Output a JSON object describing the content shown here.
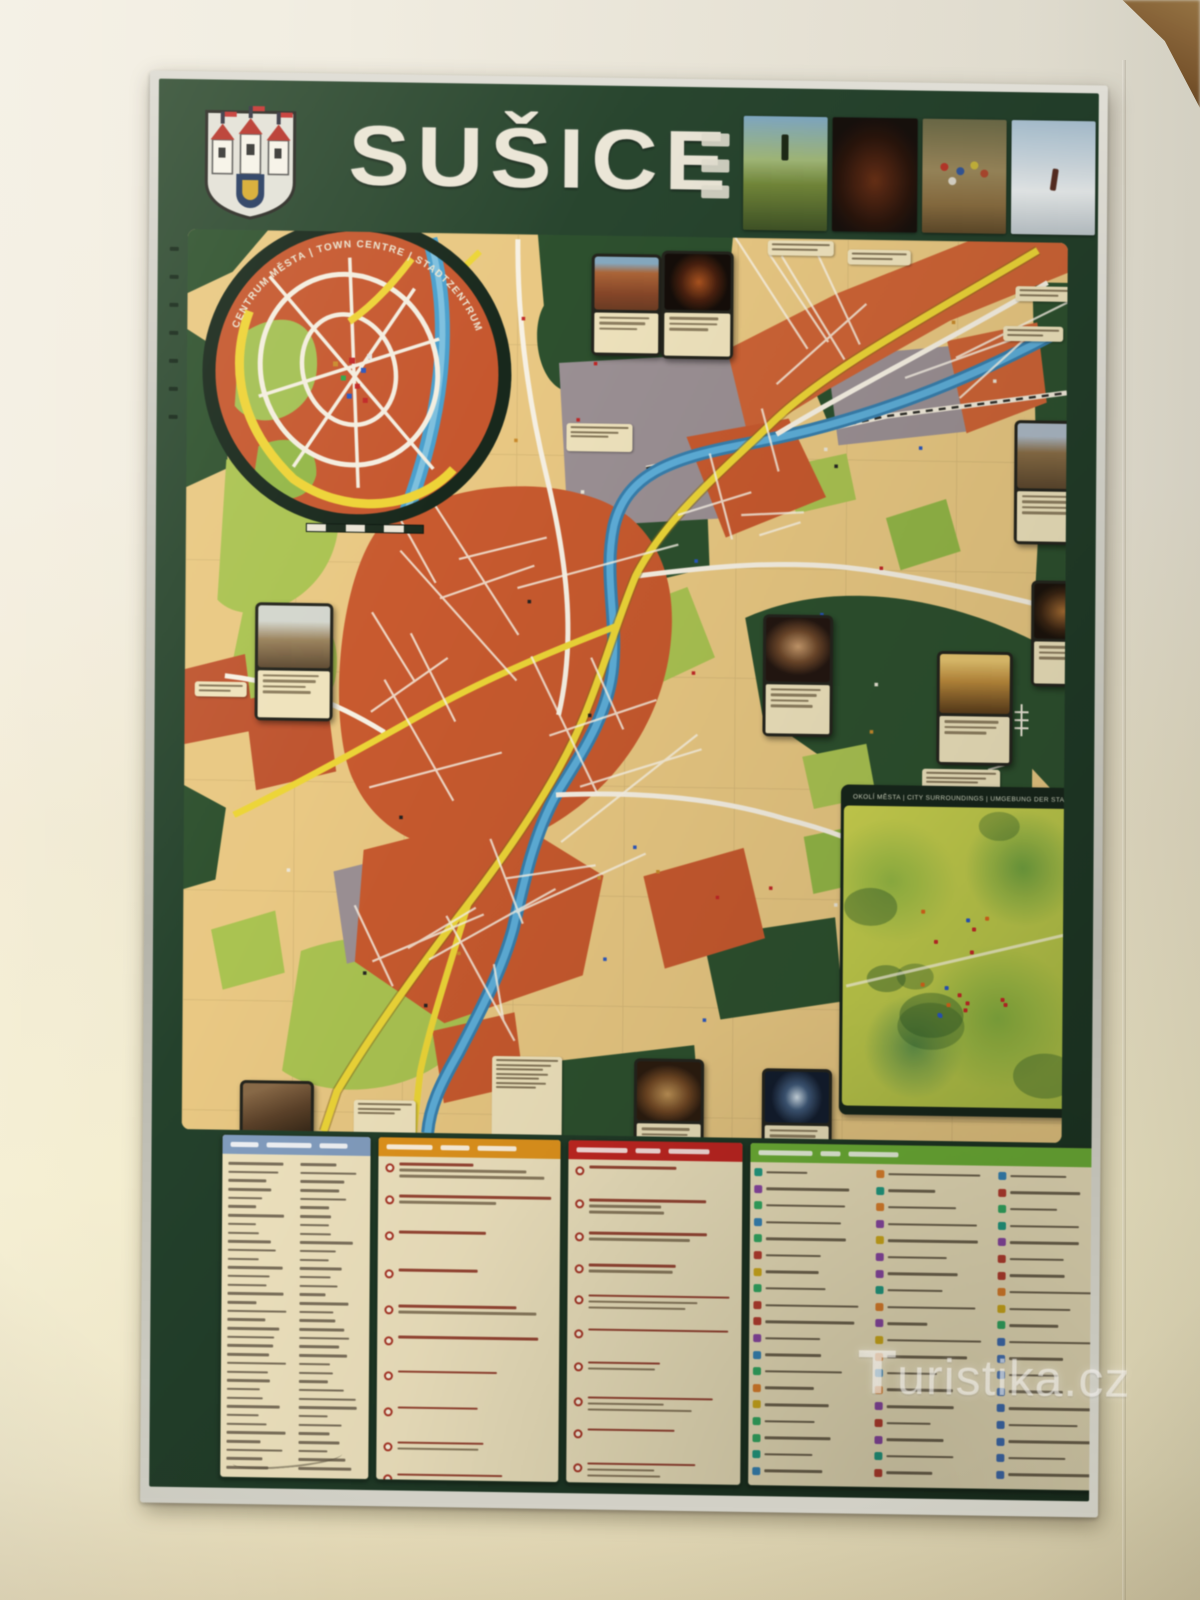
{
  "scene": {
    "description": "Photograph of a framed tourist map poster of Susice hanging on an interior wall",
    "wall_color": "#ece8d8",
    "frame_color": "#b9b9b1"
  },
  "poster": {
    "title": "SUŠICE",
    "title_color": "#e7e4d6",
    "header_bg": "#20402a",
    "coat_of_arms": "susice-city-coat-of-arms",
    "header_photos": [
      {
        "name": "memorial-on-meadow-photo"
      },
      {
        "name": "night-illuminated-church-photo"
      },
      {
        "name": "cyclists-group-photo"
      },
      {
        "name": "cross-country-skiing-photo"
      }
    ],
    "center_inset": {
      "label": "CENTRUM MĚSTA  |  TOWN CENTRE  |  STADTZENTRUM"
    },
    "surroundings_inset": {
      "label": "OKOLÍ MĚSTA  |  CITY SURROUNDINGS  |  UMGEBUNG DER STADT"
    },
    "map_palette": {
      "background": "#e9c67c",
      "built_up": "#cf5628",
      "main_road": "#ecd428",
      "street": "#f3efe4",
      "river": "#3f9fd4",
      "park_green": "#a6c348",
      "forest_green": "#29512c",
      "industrial": "#998e95"
    },
    "legend_panels": [
      {
        "name": "street-index",
        "header_color": "#7d9cc4"
      },
      {
        "name": "sights-list-orange",
        "header_color": "#e59110"
      },
      {
        "name": "sights-list-red",
        "header_color": "#cd201d"
      },
      {
        "name": "services-list-green",
        "header_color": "#67b42d"
      }
    ]
  },
  "watermark": {
    "text": "uristika.cz",
    "t_glyph": "T"
  }
}
